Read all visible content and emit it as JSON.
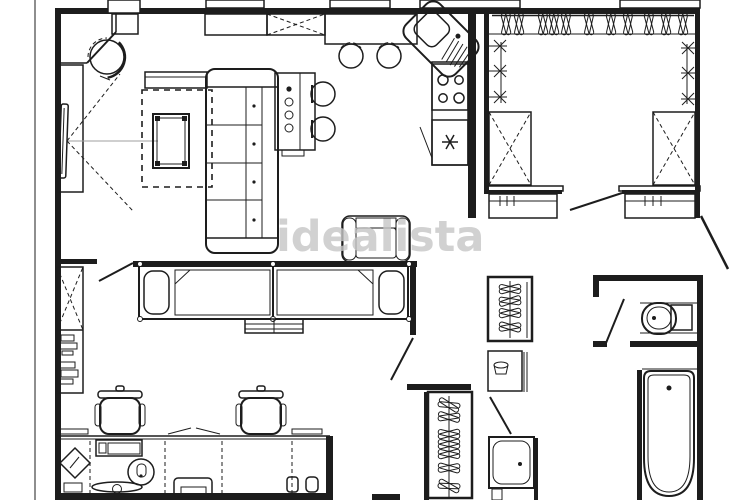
{
  "canvas": {
    "width": 750,
    "height": 500,
    "background": "#ffffff",
    "line_color": "#1d1d1d",
    "sight_line_color": "#9f9f9f"
  },
  "watermark": {
    "text": "idealista",
    "color": "#c6c6c6"
  },
  "floor_plan": {
    "type": "apartment-floor-plan",
    "rooms": [
      {
        "id": "living-room",
        "furniture": [
          "sectional-sofa",
          "media-console",
          "area-rug",
          "coffee-table",
          "tv-cabinet",
          "tv",
          "round-armchair",
          "side-table",
          "lounge-armchair"
        ]
      },
      {
        "id": "kitchen",
        "furniture": [
          "wall-cabinet",
          "tall-cabinet-x",
          "breakfast-counter",
          "bar-stool",
          "bar-stool",
          "corner-sink",
          "cooktop-4-burners",
          "freezer",
          "oven-column",
          "island-stool",
          "island-stool"
        ]
      },
      {
        "id": "walk-in-closet",
        "furniture": [
          "hanger-rail",
          "clothes-hangers",
          "wall-hooks",
          "dresser-x-left",
          "dresser-x-right",
          "shoe-drawers-left",
          "shoe-drawers-right"
        ]
      },
      {
        "id": "sleeping-area",
        "furniture": [
          "single-bed-left",
          "single-bed-right",
          "storage-bench"
        ]
      },
      {
        "id": "home-office",
        "furniture": [
          "bookshelf",
          "office-chair",
          "office-chair",
          "work-desk",
          "monitor",
          "desk-lamp",
          "keyboard",
          "printer",
          "photo-frame",
          "pen-cups"
        ]
      },
      {
        "id": "hallway",
        "furniture": [
          "coat-closet",
          "tall-wardrobe",
          "washbasin-cabinet",
          "entry-door"
        ]
      },
      {
        "id": "bathroom",
        "furniture": [
          "toilet",
          "bathtub",
          "shower-tray"
        ]
      }
    ]
  }
}
